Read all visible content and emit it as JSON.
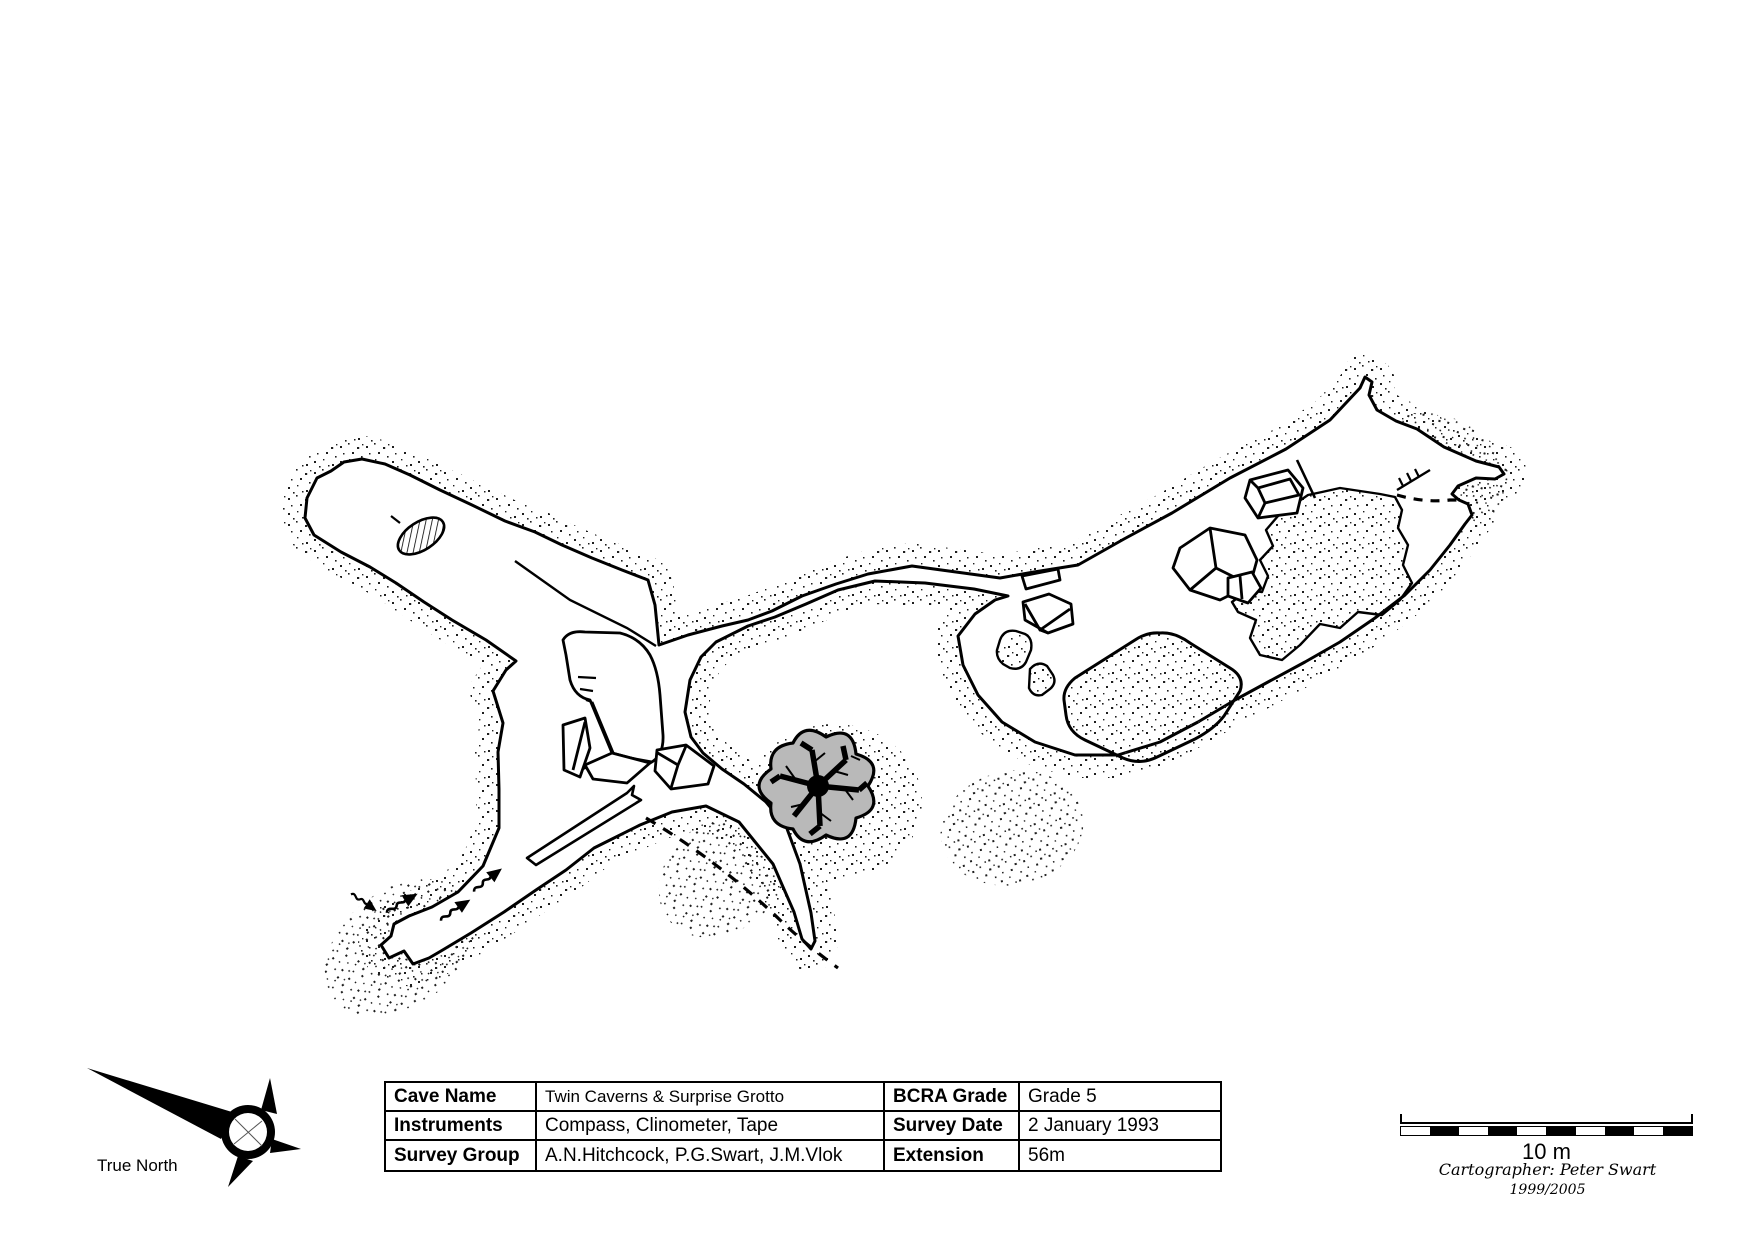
{
  "table": {
    "rows": [
      [
        "Cave Name",
        "Twin Caverns & Surprise Grotto",
        "BCRA Grade",
        "Grade 5"
      ],
      [
        "Instruments",
        "Compass, Clinometer, Tape",
        "Survey Date",
        "2 January 1993"
      ],
      [
        "Survey Group",
        "A.N.Hitchcock, P.G.Swart, J.M.Vlok",
        "Extension",
        "56m"
      ]
    ]
  },
  "north": {
    "label": "True North"
  },
  "scale": {
    "label": "10 m",
    "segments": 10,
    "segment_colors": [
      "#ffffff",
      "#000000"
    ]
  },
  "credits": {
    "cartographer": "Cartographer: Peter Swart",
    "years": "1999/2005"
  },
  "map": {
    "ink": "#000000",
    "tree_fill": "#b9b9b9",
    "background": "#ffffff"
  }
}
